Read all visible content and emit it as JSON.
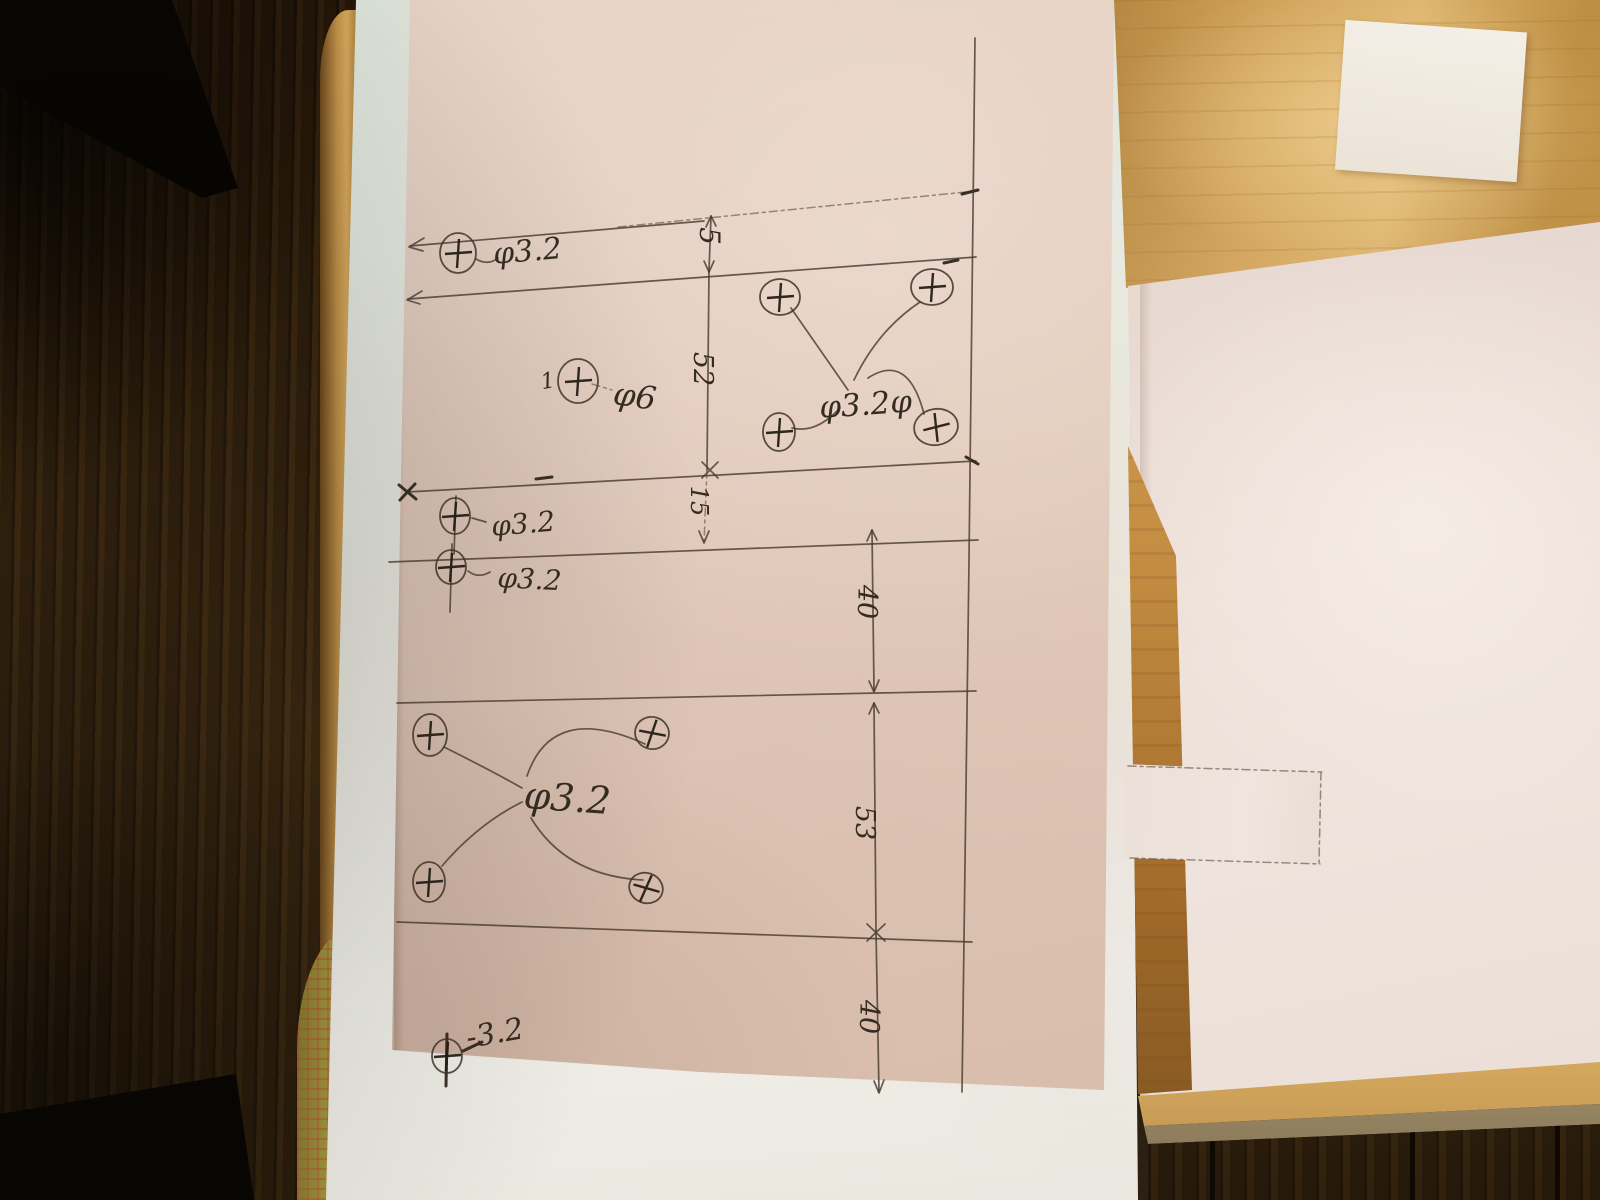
{
  "scene_colors": {
    "pink_sheet": "#dcc2b2",
    "white_paper": "#edece4",
    "right_sheet": "#e9dbd4",
    "table_wood": "#cfa055",
    "floor_wood": "#38260f",
    "pencil": "#584c40",
    "ink": "#342c22"
  },
  "drawing": {
    "hole_diameters": [
      "3.2",
      "6"
    ],
    "dimensions": [
      {
        "value": "5",
        "orientation": "vertical"
      },
      {
        "value": "52",
        "orientation": "vertical"
      },
      {
        "value": "15",
        "orientation": "vertical"
      },
      {
        "value": "40",
        "orientation": "vertical"
      },
      {
        "value": "53",
        "orientation": "vertical"
      },
      {
        "value": "40",
        "orientation": "vertical"
      }
    ],
    "labels": [
      {
        "text": "φ3.2",
        "role": "diameter",
        "x": 494,
        "y": 264,
        "s": 30,
        "r": -5
      },
      {
        "text": "5",
        "role": "dimension",
        "x": 700,
        "y": 236,
        "s": 28,
        "r": 90,
        "a": "middle"
      },
      {
        "text": "52",
        "role": "dimension",
        "x": 694,
        "y": 369,
        "s": 27,
        "r": 90,
        "a": "middle"
      },
      {
        "text": "φ6",
        "role": "diameter",
        "x": 612,
        "y": 404,
        "s": 32,
        "r": 8
      },
      {
        "text": "φ3.2φ",
        "role": "diameter",
        "x": 820,
        "y": 418,
        "s": 31,
        "r": -4
      },
      {
        "text": "15",
        "role": "dimension",
        "x": 691,
        "y": 501,
        "s": 24,
        "r": 90,
        "a": "middle"
      },
      {
        "text": "φ3.2",
        "role": "diameter",
        "x": 492,
        "y": 536,
        "s": 28,
        "r": -5
      },
      {
        "text": "φ3.2",
        "role": "diameter",
        "x": 497,
        "y": 587,
        "s": 28,
        "r": 3
      },
      {
        "text": "40",
        "role": "dimension",
        "x": 858,
        "y": 602,
        "s": 27,
        "r": 90,
        "a": "middle"
      },
      {
        "text": "φ3.2",
        "role": "diameter",
        "x": 523,
        "y": 808,
        "s": 38,
        "r": 4
      },
      {
        "text": "53",
        "role": "dimension",
        "x": 856,
        "y": 823,
        "s": 27,
        "r": 90,
        "a": "middle"
      },
      {
        "text": "40",
        "role": "dimension",
        "x": 860,
        "y": 1017,
        "s": 27,
        "r": 90,
        "a": "middle"
      },
      {
        "text": "-3.2",
        "role": "diameter",
        "x": 468,
        "y": 1048,
        "s": 30,
        "r": -10
      },
      {
        "text": "1",
        "role": "tick",
        "x": 549,
        "y": 388,
        "s": 22,
        "r": -10,
        "a": "middle"
      }
    ],
    "holes": [
      {
        "x": 458,
        "y": 253,
        "d": "3.2"
      },
      {
        "x": 578,
        "y": 381,
        "d": "6",
        "rx": 20,
        "ry": 22
      },
      {
        "x": 780,
        "y": 297,
        "d": "3.2",
        "rx": 20,
        "ry": 18
      },
      {
        "x": 932,
        "y": 287,
        "d": "3.2",
        "rx": 21,
        "ry": 18
      },
      {
        "x": 779,
        "y": 432,
        "d": "3.2",
        "rx": 16,
        "ry": 19
      },
      {
        "x": 936,
        "y": 427,
        "d": "3.2",
        "rx": 22,
        "ry": 18,
        "r": -10
      },
      {
        "x": 455,
        "y": 516,
        "d": "3.2",
        "rx": 15,
        "ry": 18
      },
      {
        "x": 451,
        "y": 567,
        "d": "3.2",
        "rx": 15,
        "ry": 17
      },
      {
        "x": 430,
        "y": 735,
        "d": "3.2",
        "rx": 17,
        "ry": 21
      },
      {
        "x": 652,
        "y": 733,
        "d": "3.2",
        "rx": 17,
        "ry": 16,
        "r": 15
      },
      {
        "x": 429,
        "y": 882,
        "d": "3.2",
        "rx": 16,
        "ry": 20
      },
      {
        "x": 646,
        "y": 888,
        "d": "3.2",
        "rx": 17,
        "ry": 15,
        "r": 20
      },
      {
        "x": 447,
        "y": 1056,
        "d": "3.2",
        "rx": 15,
        "ry": 17
      }
    ],
    "strokes": [
      {
        "d": "M618,227 L976,191",
        "k": "f"
      },
      {
        "d": "M962,194 L978,190",
        "k": "d",
        "w": 4
      },
      {
        "d": "M410,246 L704,221",
        "k": "p"
      },
      {
        "d": "M424,238 L409,247 L423,251",
        "k": "p"
      },
      {
        "d": "M408,299 L976,257",
        "k": "p"
      },
      {
        "d": "M422,291 L407,300 L420,304",
        "k": "p"
      },
      {
        "d": "M944,263 L958,260",
        "k": "d",
        "w": 6
      },
      {
        "d": "M407,492 L976,461",
        "k": "p"
      },
      {
        "d": "M399,485 L416,499 M415,484 L400,500",
        "k": "d",
        "w": 2.5
      },
      {
        "d": "M702,462 L718,478 M718,462 L702,478",
        "k": "p",
        "w": 2
      },
      {
        "d": "M966,457 L978,464",
        "k": "d",
        "w": 4
      },
      {
        "d": "M536,479 L552,477",
        "k": "d",
        "w": 6
      },
      {
        "d": "M389,562 L978,540",
        "k": "p"
      },
      {
        "d": "M397,703 L976,691",
        "k": "p"
      },
      {
        "d": "M397,922 L972,942",
        "k": "p"
      },
      {
        "d": "M867,924 L885,941 M885,924 L867,941",
        "k": "p",
        "w": 2.2
      },
      {
        "d": "M975,38 L969,560 L962,1092",
        "k": "p",
        "w": 1.8
      },
      {
        "d": "M711,216 L709,271",
        "k": "p"
      },
      {
        "d": "M706,227 L711,216 L716,226",
        "k": "p"
      },
      {
        "d": "M704,261 L709,272 L714,261",
        "k": "p"
      },
      {
        "d": "M709,271 L707,470",
        "k": "p"
      },
      {
        "d": "M707,470 L704,542",
        "k": "f"
      },
      {
        "d": "M699,531 L704,543 L709,531",
        "k": "p"
      },
      {
        "d": "M872,530 L874,691",
        "k": "p"
      },
      {
        "d": "M867,541 L872,530 L877,540",
        "k": "p"
      },
      {
        "d": "M869,681 L874,692 L879,680",
        "k": "p"
      },
      {
        "d": "M874,703 L876,931",
        "k": "p"
      },
      {
        "d": "M869,714 L874,703 L879,713",
        "k": "p"
      },
      {
        "d": "M876,931 L879,1092",
        "k": "p"
      },
      {
        "d": "M874,1081 L879,1093 L884,1080",
        "k": "p"
      },
      {
        "d": "M1128,766 L1322,772 M1130,858 L1320,864 M1321,772 L1319,864",
        "k": "f"
      },
      {
        "d": "M476,259 Q488,266 498,258",
        "k": "p"
      },
      {
        "d": "M592,384 L612,390",
        "k": "f"
      },
      {
        "d": "M791,308 L848,390",
        "k": "p"
      },
      {
        "d": "M920,302 Q878,330 854,380",
        "k": "p"
      },
      {
        "d": "M792,428 Q816,434 840,408",
        "k": "p"
      },
      {
        "d": "M868,378 Q908,352 924,414",
        "k": "p"
      },
      {
        "d": "M444,747 Q494,772 522,788",
        "k": "p"
      },
      {
        "d": "M645,744 Q552,702 527,776",
        "k": "p"
      },
      {
        "d": "M442,866 Q478,824 522,802",
        "k": "p"
      },
      {
        "d": "M643,880 Q566,876 531,818",
        "k": "p"
      },
      {
        "d": "M472,518 L486,522",
        "k": "p"
      },
      {
        "d": "M468,571 Q478,579 490,572",
        "k": "p"
      },
      {
        "d": "M463,1051 L482,1042",
        "k": "d",
        "w": 2.5
      },
      {
        "d": "M456,496 L454,554",
        "k": "p"
      },
      {
        "d": "M452,544 L450,612",
        "k": "p"
      },
      {
        "d": "M447,1034 L446,1086",
        "k": "d",
        "w": 2.2
      }
    ]
  }
}
